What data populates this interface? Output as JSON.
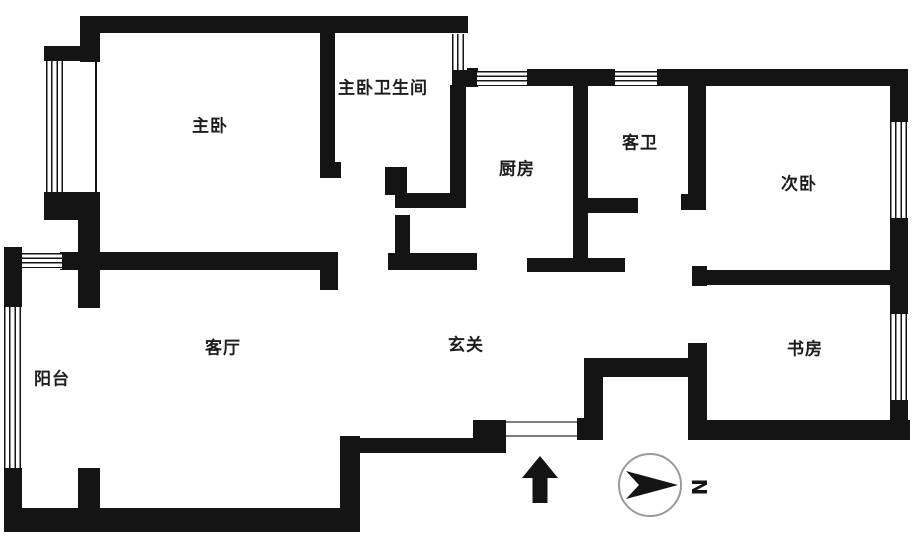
{
  "page": {
    "background": "#ffffff"
  },
  "floorplan": {
    "width": 918,
    "height": 541,
    "wall_color": "#141414",
    "rooms": [
      {
        "id": "master-bedroom",
        "label": "主卧",
        "cx": 210,
        "cy": 124
      },
      {
        "id": "master-bathroom",
        "label": "主卧卫生间",
        "cx": 383,
        "cy": 86
      },
      {
        "id": "kitchen",
        "label": "厨房",
        "cx": 517,
        "cy": 167
      },
      {
        "id": "guest-bathroom",
        "label": "客卫",
        "cx": 640,
        "cy": 141
      },
      {
        "id": "second-bedroom",
        "label": "次卧",
        "cx": 799,
        "cy": 182
      },
      {
        "id": "living-room",
        "label": "客厅",
        "cx": 223,
        "cy": 346
      },
      {
        "id": "entrance-hall",
        "label": "玄关",
        "cx": 466,
        "cy": 343
      },
      {
        "id": "study",
        "label": "书房",
        "cx": 805,
        "cy": 347
      },
      {
        "id": "balcony",
        "label": "阳台",
        "cx": 52,
        "cy": 377
      }
    ],
    "walls": [
      {
        "x": 80,
        "y": 16,
        "w": 388,
        "h": 17
      },
      {
        "x": 80,
        "y": 16,
        "w": 20,
        "h": 46
      },
      {
        "x": 44,
        "y": 46,
        "w": 42,
        "h": 15
      },
      {
        "x": 95,
        "y": 61,
        "w": 2,
        "h": 131
      },
      {
        "x": 44,
        "y": 192,
        "w": 56,
        "h": 28
      },
      {
        "x": 78,
        "y": 218,
        "w": 22,
        "h": 90
      },
      {
        "x": 60,
        "y": 252,
        "w": 278,
        "h": 18
      },
      {
        "x": 320,
        "y": 268,
        "w": 18,
        "h": 22
      },
      {
        "x": 320,
        "y": 33,
        "w": 15,
        "h": 136
      },
      {
        "x": 320,
        "y": 162,
        "w": 21,
        "h": 16
      },
      {
        "x": 4,
        "y": 247,
        "w": 18,
        "h": 60
      },
      {
        "x": 4,
        "y": 468,
        "w": 18,
        "h": 64
      },
      {
        "x": 78,
        "y": 468,
        "w": 22,
        "h": 48
      },
      {
        "x": 4,
        "y": 508,
        "w": 356,
        "h": 24
      },
      {
        "x": 340,
        "y": 436,
        "w": 20,
        "h": 72
      },
      {
        "x": 360,
        "y": 438,
        "w": 146,
        "h": 15
      },
      {
        "x": 473,
        "y": 420,
        "w": 33,
        "h": 18
      },
      {
        "x": 577,
        "y": 418,
        "w": 26,
        "h": 22
      },
      {
        "x": 584,
        "y": 358,
        "w": 19,
        "h": 82
      },
      {
        "x": 584,
        "y": 358,
        "w": 123,
        "h": 19
      },
      {
        "x": 688,
        "y": 343,
        "w": 19,
        "h": 97
      },
      {
        "x": 688,
        "y": 420,
        "w": 222,
        "h": 20
      },
      {
        "x": 452,
        "y": 68,
        "w": 26,
        "h": 19
      },
      {
        "x": 450,
        "y": 85,
        "w": 16,
        "h": 123
      },
      {
        "x": 395,
        "y": 193,
        "w": 71,
        "h": 15
      },
      {
        "x": 385,
        "y": 167,
        "w": 22,
        "h": 28
      },
      {
        "x": 395,
        "y": 215,
        "w": 15,
        "h": 55
      },
      {
        "x": 388,
        "y": 253,
        "w": 89,
        "h": 17
      },
      {
        "x": 527,
        "y": 69,
        "w": 88,
        "h": 17
      },
      {
        "x": 657,
        "y": 69,
        "w": 251,
        "h": 17
      },
      {
        "x": 573,
        "y": 85,
        "w": 15,
        "h": 178
      },
      {
        "x": 588,
        "y": 198,
        "w": 50,
        "h": 15
      },
      {
        "x": 527,
        "y": 258,
        "w": 98,
        "h": 14
      },
      {
        "x": 688,
        "y": 85,
        "w": 18,
        "h": 113
      },
      {
        "x": 681,
        "y": 194,
        "w": 25,
        "h": 16
      },
      {
        "x": 692,
        "y": 266,
        "w": 15,
        "h": 20
      },
      {
        "x": 692,
        "y": 270,
        "w": 216,
        "h": 15
      },
      {
        "x": 890,
        "y": 69,
        "w": 18,
        "h": 53
      },
      {
        "x": 890,
        "y": 218,
        "w": 18,
        "h": 96
      },
      {
        "x": 890,
        "y": 400,
        "w": 18,
        "h": 40
      }
    ],
    "windows": [
      {
        "x": 46,
        "y": 61,
        "w": 21,
        "h": 131,
        "orient": "v"
      },
      {
        "x": 4,
        "y": 307,
        "w": 18,
        "h": 161,
        "orient": "v"
      },
      {
        "x": 22,
        "y": 253,
        "w": 40,
        "h": 16,
        "orient": "h"
      },
      {
        "x": 452,
        "y": 34,
        "w": 15,
        "h": 36,
        "orient": "v"
      },
      {
        "x": 477,
        "y": 71,
        "w": 50,
        "h": 15,
        "orient": "h"
      },
      {
        "x": 615,
        "y": 71,
        "w": 42,
        "h": 15,
        "orient": "h"
      },
      {
        "x": 890,
        "y": 122,
        "w": 18,
        "h": 96,
        "orient": "v"
      },
      {
        "x": 890,
        "y": 314,
        "w": 18,
        "h": 86,
        "orient": "v"
      }
    ],
    "entry_door": {
      "x": 506,
      "y": 421,
      "w": 71,
      "h": 16
    },
    "entry_arrow": {
      "x": 522,
      "y": 456,
      "w": 36,
      "h": 47
    },
    "compass": {
      "cx": 650,
      "cy": 485,
      "r": 32,
      "north_label": "N",
      "arrow_color": "#141414",
      "ring_color": "#9a9a9a"
    }
  }
}
